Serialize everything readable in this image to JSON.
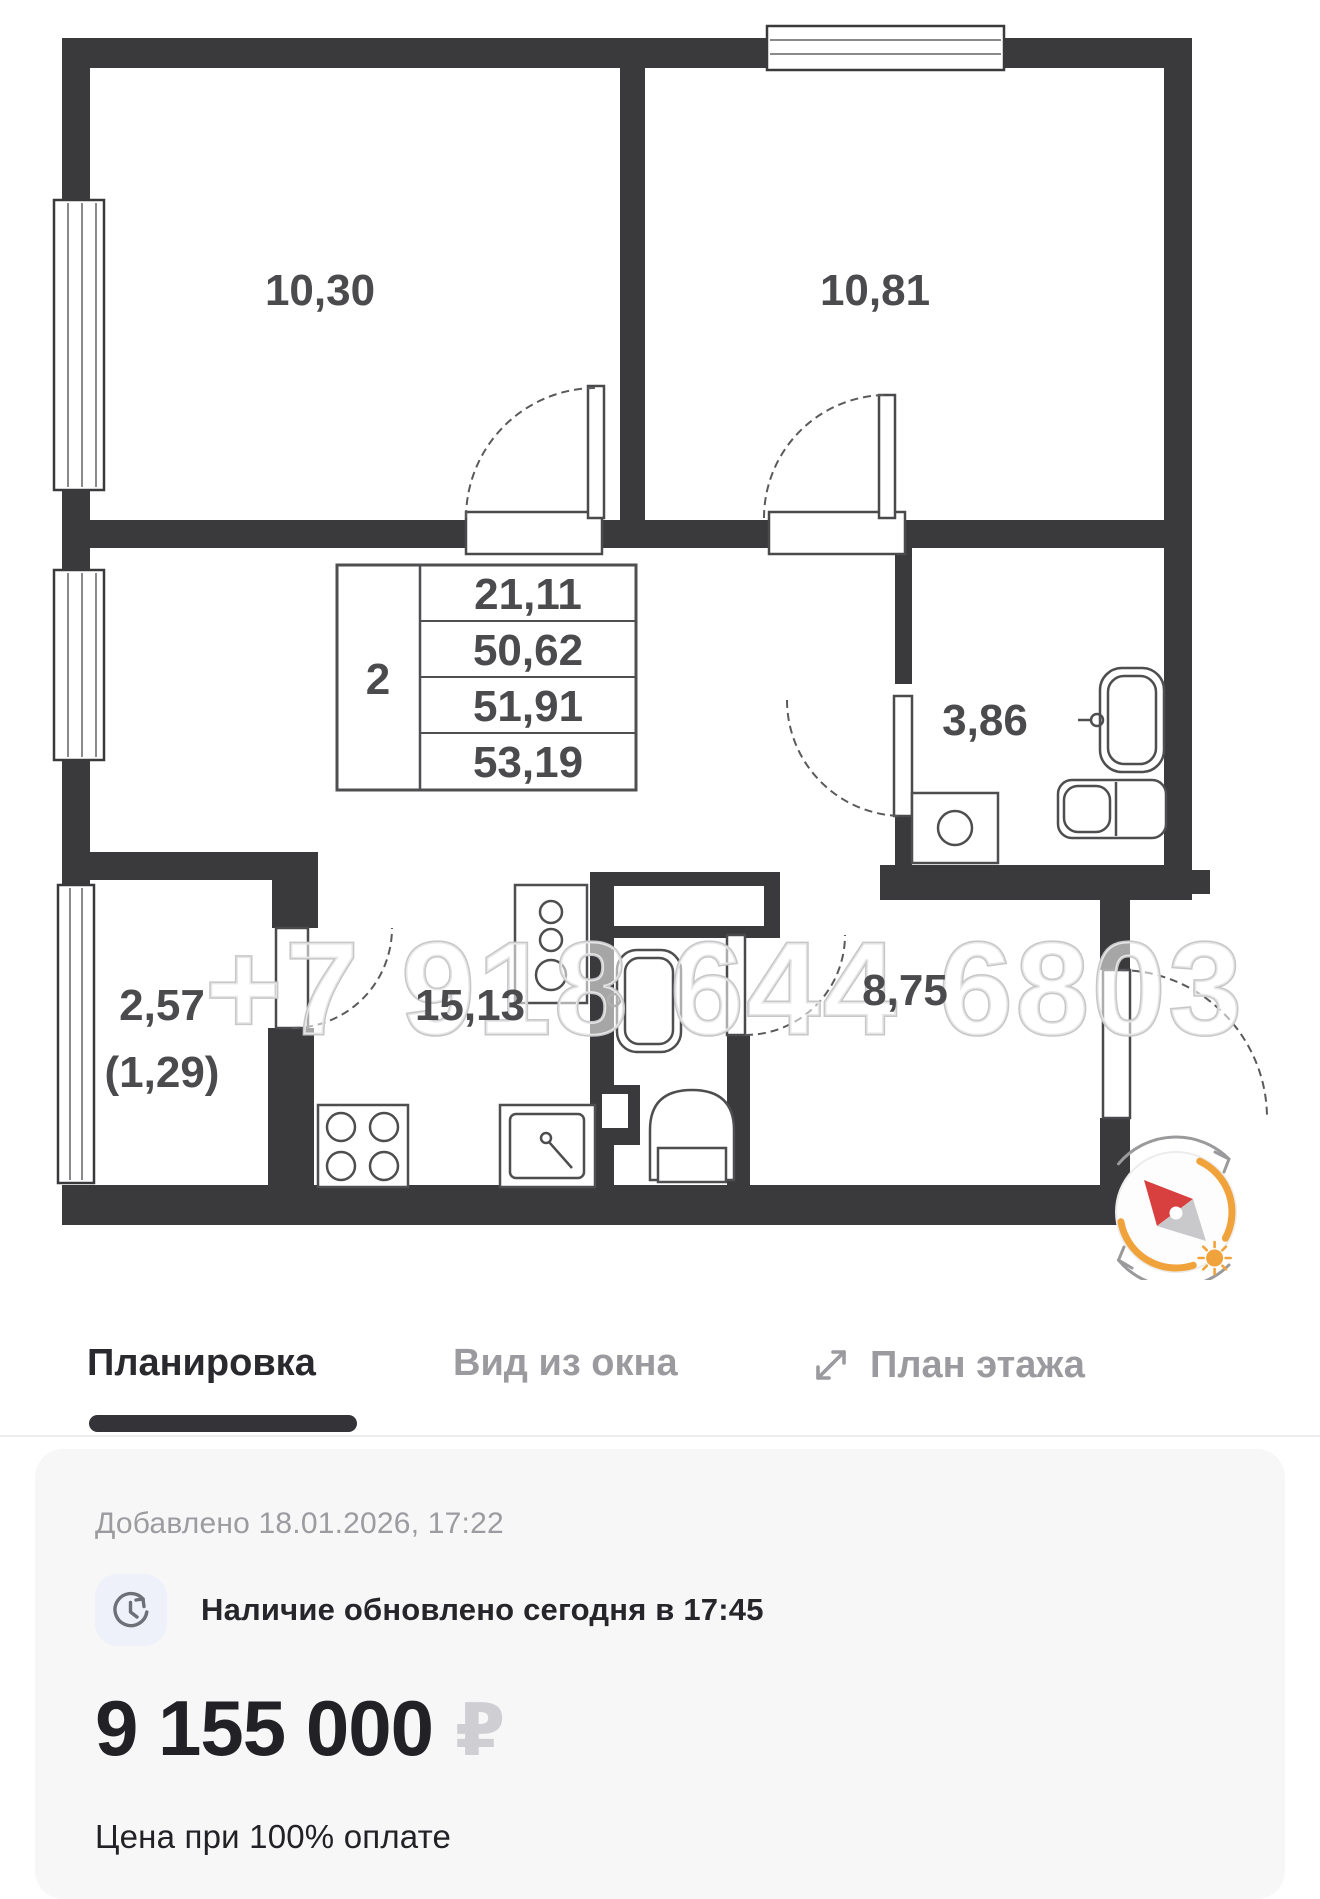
{
  "floorplan": {
    "watermark": "+7 918 644 6803",
    "summary_table": {
      "rooms_count": "2",
      "rows": [
        "21,11",
        "50,62",
        "51,91",
        "53,19"
      ]
    },
    "rooms": {
      "bedroom_1": "10,30",
      "bedroom_2": "10,81",
      "bathroom": "3,86",
      "balcony_total": "2,57",
      "balcony_reduced": "(1,29)",
      "kitchen": "15,13",
      "hallway": "8,75"
    }
  },
  "tabs": [
    {
      "label": "Планировка",
      "active": true
    },
    {
      "label": "Вид из окна",
      "active": false
    },
    {
      "label": "План этажа",
      "active": false,
      "icon": "expand-icon"
    }
  ],
  "details": {
    "added_label": "Добавлено 18.01.2026, 17:22",
    "availability": "Наличие обновлено сегодня в 17:45",
    "price": "9 155 000",
    "currency": "₽",
    "price_note": "Цена при 100% оплате"
  },
  "colors": {
    "wall": "#3A3A3C",
    "accent_orange": "#F1A33B",
    "needle_red": "#D84040",
    "tab_active": "#2A2A2E",
    "tab_inactive": "#9B9B9F",
    "card_bg": "#F7F7F8",
    "muted_text": "#9C9CA0",
    "ruble_gray": "#CFCFD3"
  }
}
